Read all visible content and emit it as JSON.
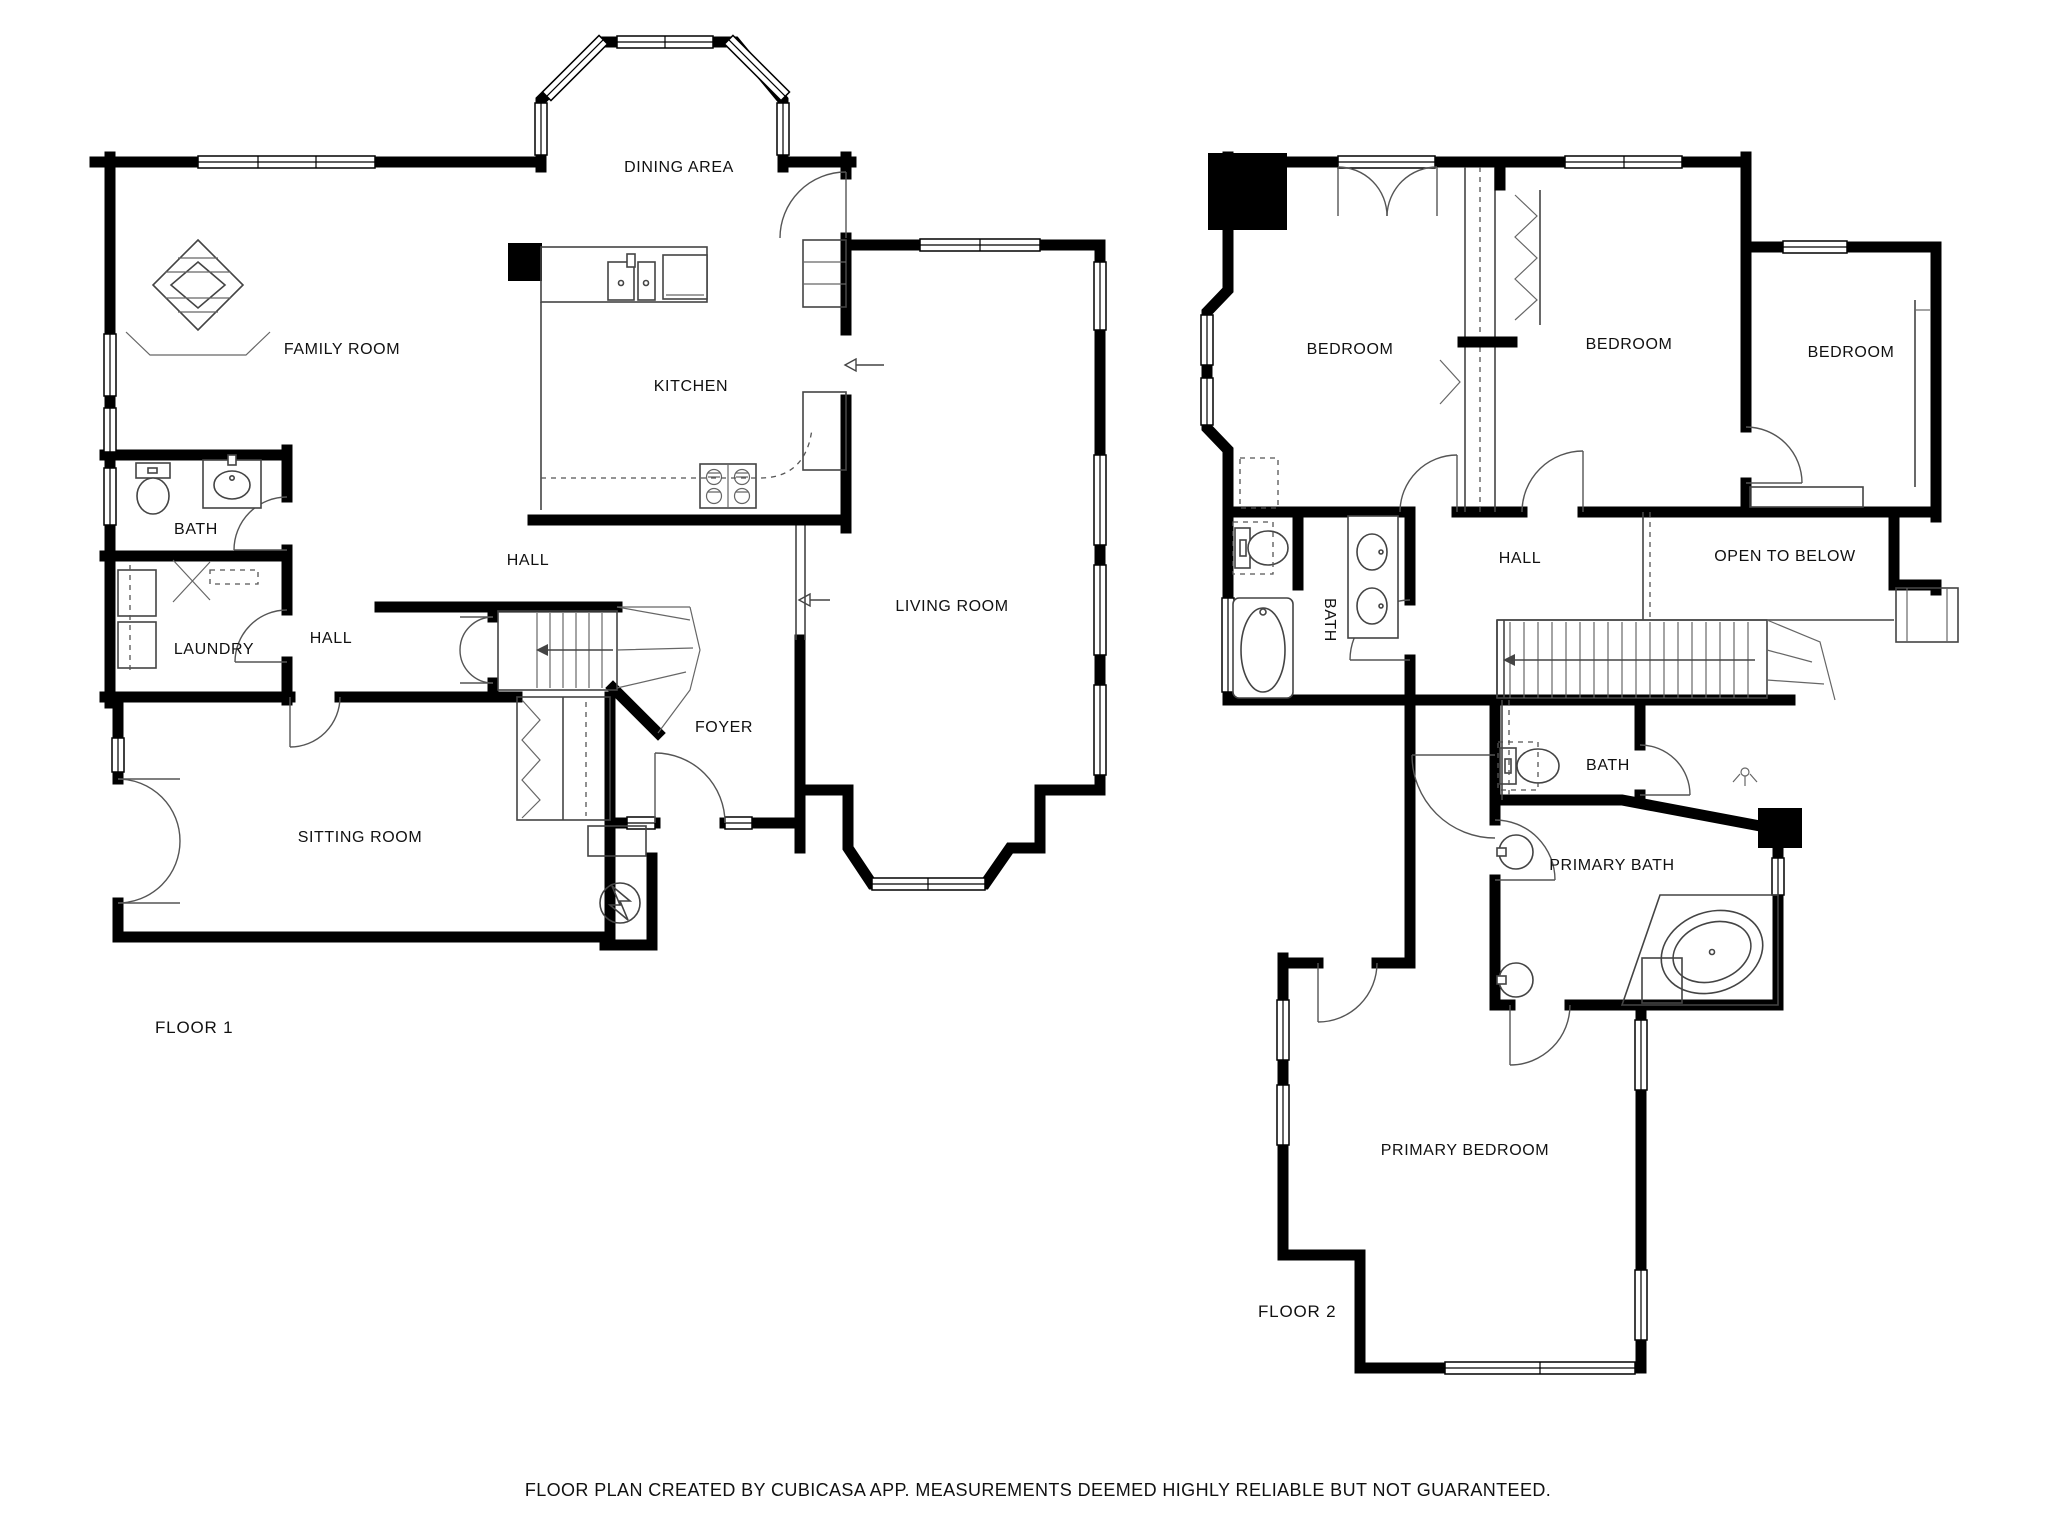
{
  "document": {
    "type": "floor-plan",
    "source_note": "FLOOR PLAN CREATED BY CUBICASA APP. MEASUREMENTS DEEMED HIGHLY RELIABLE BUT NOT GUARANTEED."
  },
  "colors": {
    "walls": "#000000",
    "background": "#ffffff",
    "fixtures": "#444444",
    "text": "#111111"
  },
  "floors": [
    {
      "name": "FLOOR 1",
      "rooms": [
        {
          "id": "dining-area",
          "label": "DINING AREA"
        },
        {
          "id": "family-room",
          "label": "FAMILY ROOM"
        },
        {
          "id": "kitchen",
          "label": "KITCHEN"
        },
        {
          "id": "bath-1",
          "label": "BATH"
        },
        {
          "id": "hall-main",
          "label": "HALL"
        },
        {
          "id": "laundry",
          "label": "LAUNDRY"
        },
        {
          "id": "hall-small",
          "label": "HALL"
        },
        {
          "id": "foyer",
          "label": "FOYER"
        },
        {
          "id": "living-room",
          "label": "LIVING ROOM"
        },
        {
          "id": "sitting-room",
          "label": "SITTING ROOM"
        }
      ],
      "icons": [
        "fireplace-icon",
        "stairs-icon",
        "electrical-panel-icon",
        "stove-icon",
        "sink-icon",
        "toilet-icon",
        "washer-dryer-icon"
      ]
    },
    {
      "name": "FLOOR 2",
      "rooms": [
        {
          "id": "bedroom-1",
          "label": "BEDROOM"
        },
        {
          "id": "bedroom-2",
          "label": "BEDROOM"
        },
        {
          "id": "bedroom-3",
          "label": "BEDROOM"
        },
        {
          "id": "hall-2",
          "label": "HALL"
        },
        {
          "id": "open-to-below",
          "label": "OPEN TO BELOW"
        },
        {
          "id": "bath-2-left",
          "label": "BATH"
        },
        {
          "id": "bath-2-small",
          "label": "BATH"
        },
        {
          "id": "primary-bath",
          "label": "PRIMARY BATH"
        },
        {
          "id": "primary-bedroom",
          "label": "PRIMARY BEDROOM"
        }
      ],
      "icons": [
        "stairs-icon",
        "tub-icon",
        "corner-tub-icon",
        "toilet-icon",
        "double-sink-icon",
        "chimney-icon"
      ]
    }
  ],
  "footer": {
    "text": "FLOOR PLAN CREATED BY CUBICASA APP. MEASUREMENTS DEEMED HIGHLY RELIABLE BUT NOT GUARANTEED."
  }
}
